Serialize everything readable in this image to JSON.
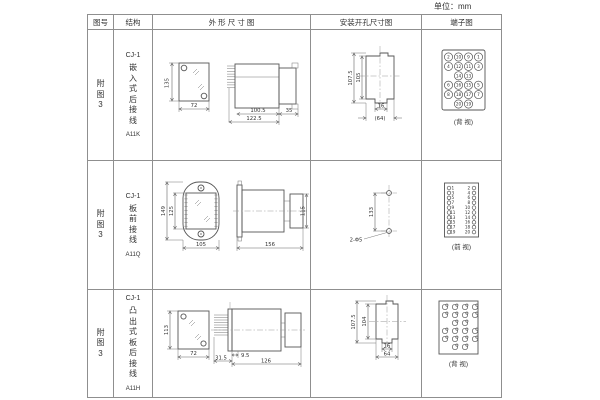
{
  "unit_label": "单位：mm",
  "header": {
    "fig_no": "图号",
    "structure": "结构",
    "outline": "外 形 尺 寸 图",
    "mounting": "安装开孔尺寸图",
    "terminal": "端子图"
  },
  "rows": [
    {
      "fig_label": "附图3",
      "model": "CJ-1",
      "mount_type": "嵌入式后接线",
      "code": "A11K",
      "outline": {
        "front_height": "135",
        "front_width": "72",
        "body_depth": "100.5",
        "total_depth": "122.5",
        "rear_width": "35"
      },
      "mounting": {
        "outer_height": "107.5",
        "inner_height": "105",
        "notch_width": "16",
        "cutout_width": "(64)"
      },
      "terminal": {
        "view_label": "(背 视)",
        "pins": [
          [
            "2",
            "10",
            "9",
            "1"
          ],
          [
            "4",
            "12",
            "11",
            "3"
          ],
          [
            "",
            "14",
            "13",
            ""
          ],
          [
            "6",
            "16",
            "15",
            "5"
          ],
          [
            "8",
            "18",
            "17",
            "7"
          ],
          [
            "",
            "20",
            "19",
            ""
          ]
        ]
      }
    },
    {
      "fig_label": "附图3",
      "model": "CJ-1",
      "mount_type": "板前接线",
      "code": "A11Q",
      "outline": {
        "outer_height": "149",
        "inner_height": "125",
        "front_width": "105",
        "total_depth": "156",
        "rear_height": "115"
      },
      "mounting": {
        "hole_spacing": "133",
        "holes_label": "2-Φ5"
      },
      "terminal": {
        "view_label": "(前 视)",
        "left": [
          "1",
          "3",
          "5",
          "7",
          "9",
          "11",
          "13",
          "15",
          "17",
          "19"
        ],
        "right": [
          "2",
          "4",
          "6",
          "8",
          "10",
          "12",
          "14",
          "16",
          "18",
          "20"
        ]
      }
    },
    {
      "fig_label": "附图3",
      "model": "CJ-1",
      "mount_type": "凸出式板后接线",
      "code": "A11H",
      "outline": {
        "front_height": "113",
        "front_width": "72",
        "pin_length": "31.5",
        "pin_offset": "9.5",
        "body_depth": "126"
      },
      "mounting": {
        "outer_height": "107.5",
        "inner_height": "104",
        "notch_width": "16",
        "cutout_width": "64"
      },
      "terminal": {
        "view_label": "(背 视)",
        "pins": [
          [
            1,
            1,
            1,
            1
          ],
          [
            1,
            1,
            1,
            1
          ],
          [
            0,
            1,
            1,
            0
          ],
          [
            1,
            1,
            1,
            1
          ],
          [
            1,
            1,
            1,
            1
          ],
          [
            0,
            1,
            1,
            0
          ]
        ]
      }
    }
  ]
}
